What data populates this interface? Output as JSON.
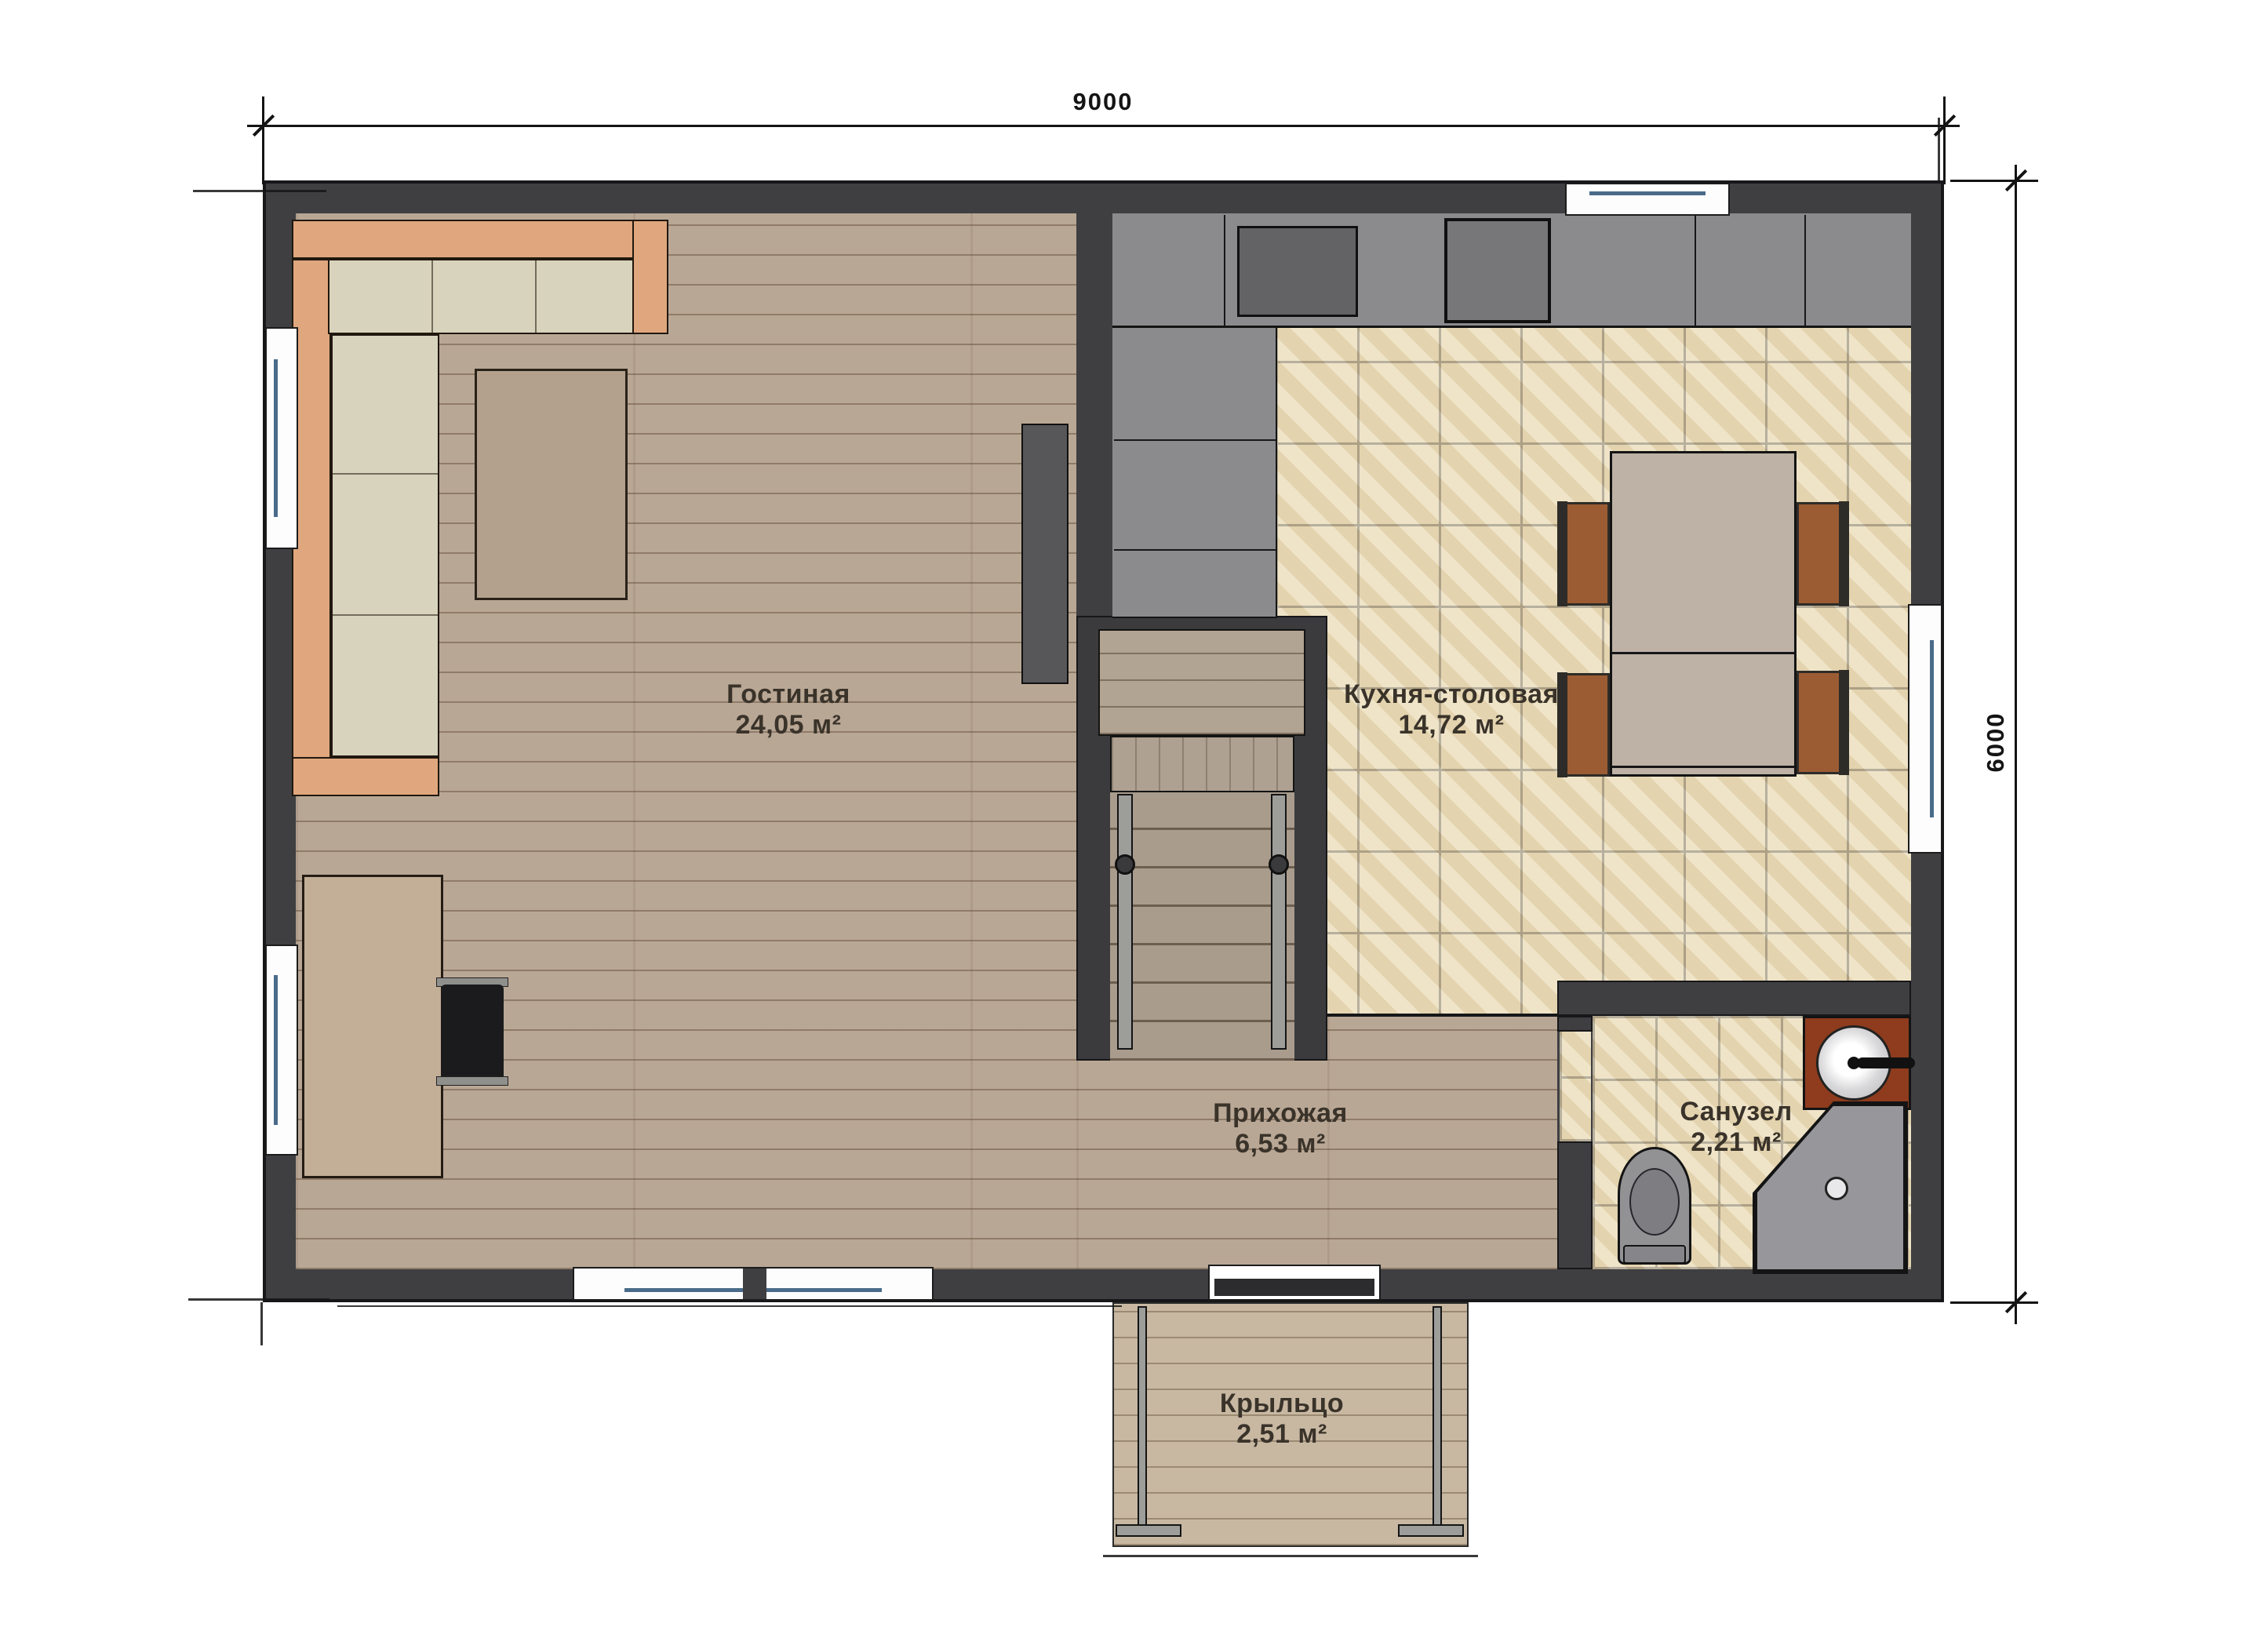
{
  "plan": {
    "dimensions": {
      "width_label": "9000",
      "height_label": "6000"
    },
    "rooms": [
      {
        "id": "living",
        "name": "Гостиная",
        "area": "24,05 м²"
      },
      {
        "id": "kitchen",
        "name": "Кухня-столовая",
        "area": "14,72 м²"
      },
      {
        "id": "hallway",
        "name": "Прихожая",
        "area": "6,53 м²"
      },
      {
        "id": "bathroom",
        "name": "Санузел",
        "area": "2,21 м²"
      },
      {
        "id": "porch",
        "name": "Крыльцо",
        "area": "2,51 м²"
      }
    ]
  },
  "colors": {
    "wall": "#3f3f42",
    "outline": "#17171a",
    "wood-floor": "#b9a795",
    "porch-wood": "#c8b8a2",
    "tile": "#e9dcba",
    "tile-grout": "#99927f",
    "counter": "#8b8b8e",
    "appliance": "#636366",
    "sofa-cushion": "#d8d3bc",
    "sofa-frame": "#e0a77e",
    "table-wood": "#b3a18d",
    "desk-wood": "#c3ae97",
    "dining-wood": "#bdb2a5",
    "chair-seat": "#9c5c33",
    "chair-frame": "#2e2c28",
    "stair-tread": "#a99c8d",
    "landing-wood": "#b2a492",
    "rail": "#9d9d9a",
    "fixture": "#929295",
    "vanity": "#8e3c1d",
    "tv-console": "#57575a",
    "door-leaf": "#2c2c2e",
    "glass": "#4a6b8a",
    "dim": "#141414"
  }
}
